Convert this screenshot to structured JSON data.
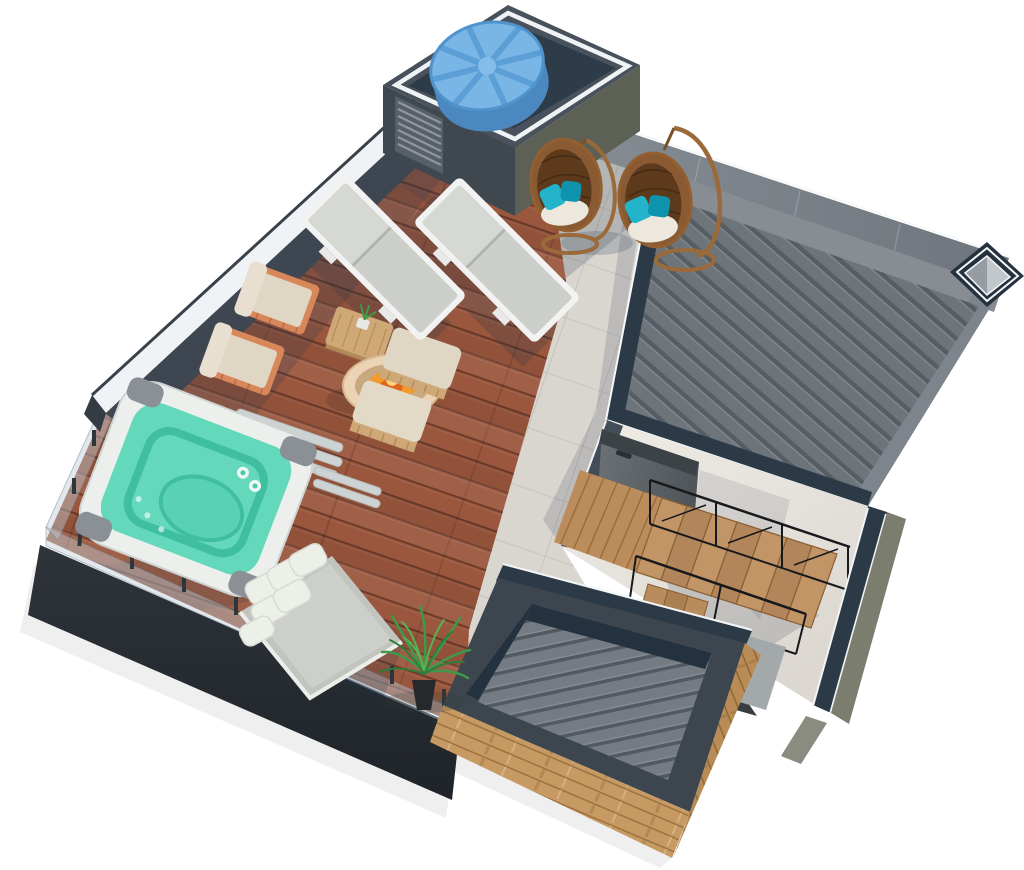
{
  "scene": {
    "kind": "rooftop-terrace-3d-floor-plan",
    "background": "#ffffff"
  },
  "palette": {
    "deck_plank": "#9a573d",
    "deck_gap": "#6f3b2b",
    "tile_base": "#d9d5cf",
    "tile_grout": "#c3bdb5",
    "roof_rib": "#6d747a",
    "roof_groove": "#565d63",
    "roof_rib_hi": "#7f868d",
    "roof_border": "#878d93",
    "band_light": "#858c93",
    "band_dark": "#6e757c",
    "navy": "#2c3947",
    "navy_deep": "#243240",
    "trim_white": "#f5f7f8",
    "parapet": "#3e4751",
    "coping": "#f0f3f5",
    "charcoal": "#2e343a",
    "charcoal_deep": "#1f2429",
    "block_top": "#49525c",
    "block_left": "#3f474f",
    "block_right": "#5d6055",
    "olive": "#7b7d6e",
    "plaster_light": "#efece6",
    "plaster_dark": "#dcd8d1",
    "tank_lid": "#79b6e6",
    "tank_side": "#5b9dd3",
    "tank_groove": "#5c9fd6",
    "tank_rim": "#4f93cc",
    "water": "#63d8bb",
    "water_contour": "#3fbf9f",
    "tub_shell": "#ecefec",
    "tub_pad": "#8a9096",
    "bamboo": "#c79a63",
    "bamboo_line": "#9c7240",
    "oak": "#bb8c5c",
    "tread_a": "#c29566",
    "tread_b": "#b2865a",
    "riser": "#8a5f33",
    "frame_white": "#f1f2f1",
    "lounger_cushion": "#cbcec9",
    "lounger_back": "#d6d8d4",
    "beige": "#e0d6c4",
    "terracotta": "#d8875a",
    "rattan": "#cfa877",
    "wicker": "#8a5a33",
    "wicker_dark": "#5e3a1c",
    "cushion_white": "#ece8dd",
    "teal_pillow": "#23b3ca",
    "teal_pillow_dark": "#0f93ac",
    "gray_cushion": "#c2c5bf",
    "pillow_white": "#edefe9",
    "fire_bowl": "#ecd3b4",
    "fire": "#f29a2a",
    "fire_deep": "#e0641c",
    "fire_hi": "#ffd47e",
    "plant_green": "#3e9a49",
    "plant_green_dark": "#2f7c3a",
    "plant_green_light": "#55b353",
    "hatch_light": "#6d7377",
    "hatch_dark": "#4f5559",
    "railing_black": "#17191c",
    "glass": "rgba(190,205,214,0.45)",
    "slab_gray": "#a3a8ab",
    "skylight_inner": "#969ca1",
    "skylight_inner_lit": "#c2c7cb"
  }
}
